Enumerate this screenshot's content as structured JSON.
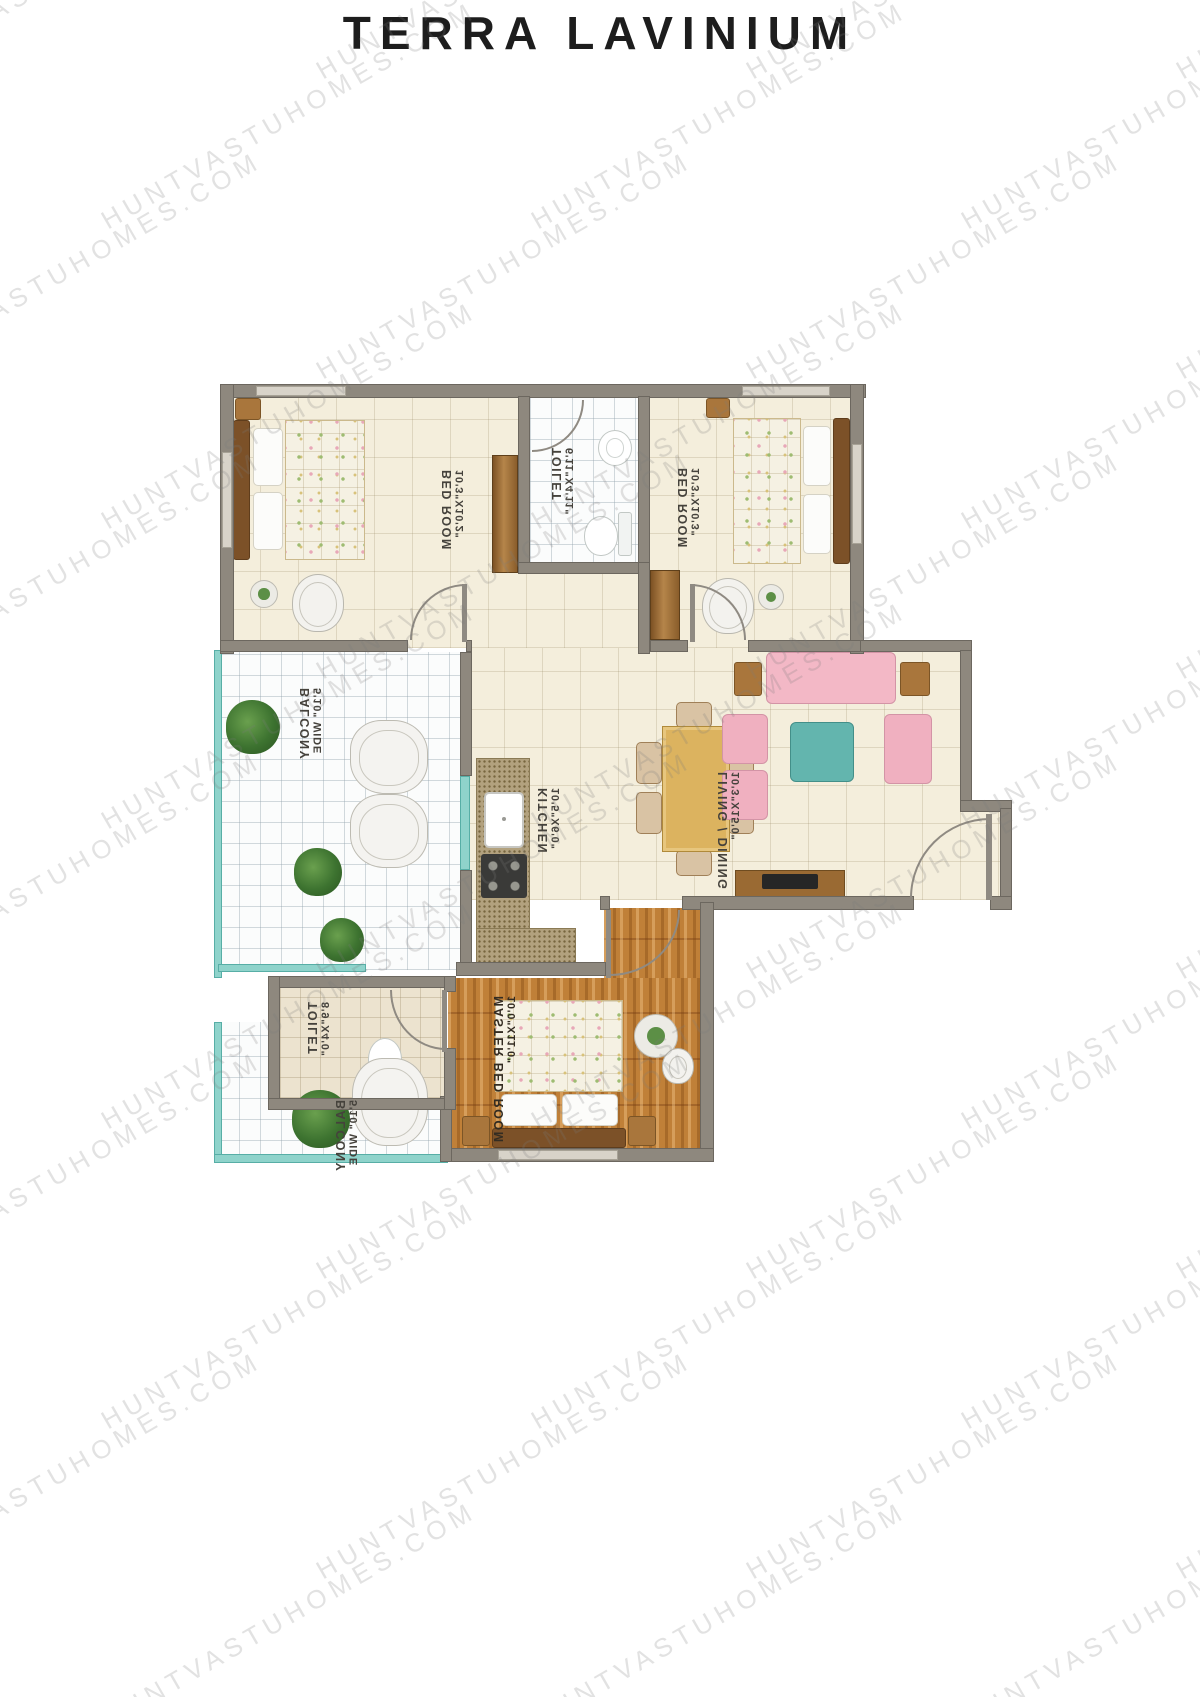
{
  "title": "TERRA LAVINIUM",
  "watermark": {
    "text": "HUNTVASTUHOMES.COM"
  },
  "plan": {
    "rooms": [
      {
        "id": "bedroom-1",
        "name": "BED ROOM",
        "dim": "10'3\"X10'2\""
      },
      {
        "id": "toilet-1",
        "name": "TOILET",
        "dim": "6'11\"X4'11\""
      },
      {
        "id": "bedroom-2",
        "name": "BED ROOM",
        "dim": "10'3\"X10'3\""
      },
      {
        "id": "balcony-1",
        "name": "BALCONY",
        "dim": "5'10\" WIDE"
      },
      {
        "id": "kitchen",
        "name": "KITCHEN",
        "dim": "10'5\"X6'0\""
      },
      {
        "id": "living-dining",
        "name": "LIVING / DINING",
        "dim": "10'3\"X15'0\""
      },
      {
        "id": "toilet-2",
        "name": "TOILET",
        "dim": "8'9\"X4'0\""
      },
      {
        "id": "master-bedroom",
        "name": "MASTER BED ROOM",
        "dim": "10'0\"X11'0\""
      },
      {
        "id": "balcony-2",
        "name": "BALCONY",
        "dim": "5'10\" WIDE"
      }
    ]
  }
}
